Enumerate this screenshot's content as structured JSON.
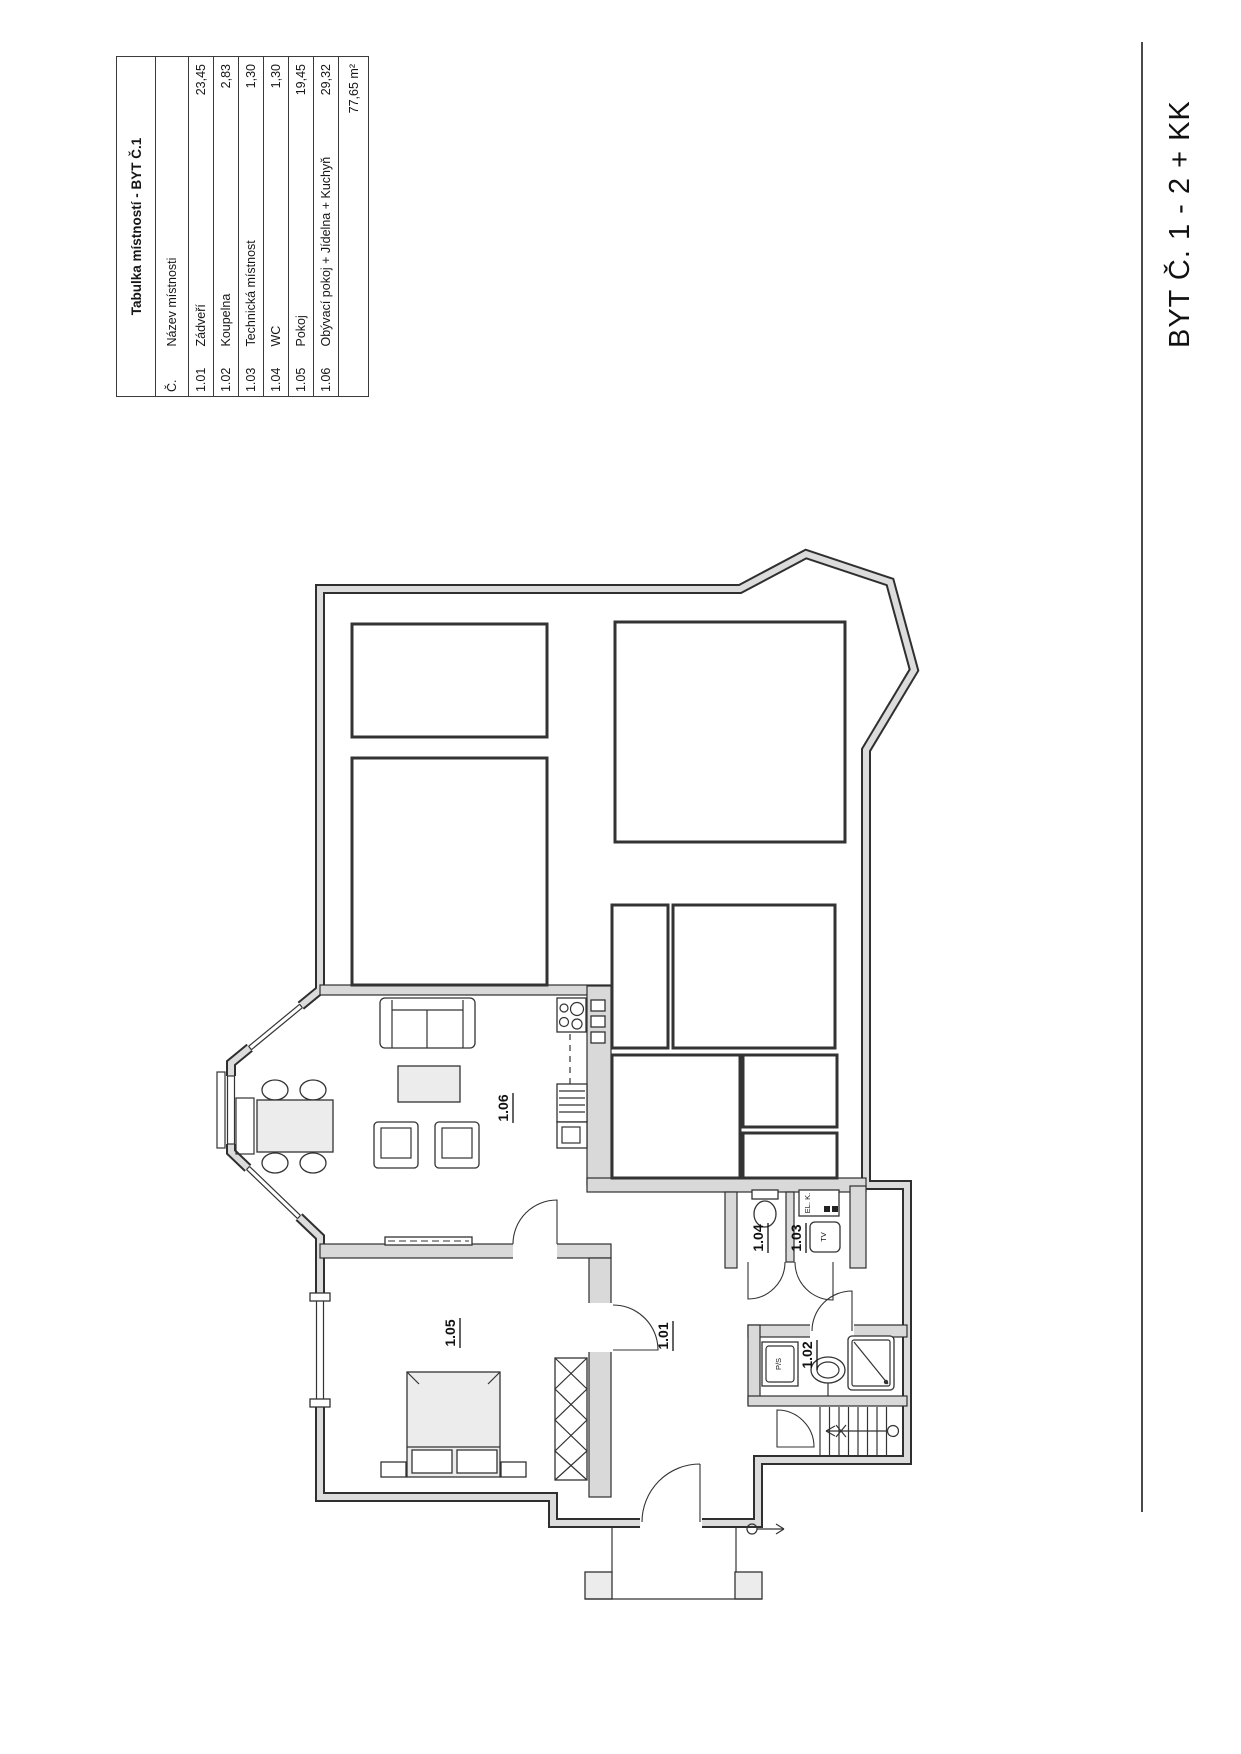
{
  "sheet": {
    "title": "BYT Č. 1 - 2 + KK"
  },
  "room_table": {
    "title": "Tabulka místností - BYT Č.1",
    "columns": {
      "number": "Č.",
      "name": "Název místnosti",
      "area": ""
    },
    "rows": [
      {
        "number": "1.01",
        "name": "Zádveří",
        "area": "23,45"
      },
      {
        "number": "1.02",
        "name": "Koupelna",
        "area": "2,83"
      },
      {
        "number": "1.03",
        "name": "Technická místnost",
        "area": "1,30"
      },
      {
        "number": "1.04",
        "name": "WC",
        "area": "1,30"
      },
      {
        "number": "1.05",
        "name": "Pokoj",
        "area": "19,45"
      },
      {
        "number": "1.06",
        "name": "Obývací pokoj + Jídelna + Kuchyň",
        "area": "29,32"
      }
    ],
    "total_area": "77,65 m²"
  },
  "plan": {
    "room_labels": {
      "hall": "1.01",
      "bathroom": "1.02",
      "technical": "1.03",
      "wc": "1.04",
      "room": "1.05",
      "living": "1.06"
    },
    "fixture_labels": {
      "washer": "P/S",
      "tv": "TV",
      "electrical": "EL. K."
    }
  }
}
